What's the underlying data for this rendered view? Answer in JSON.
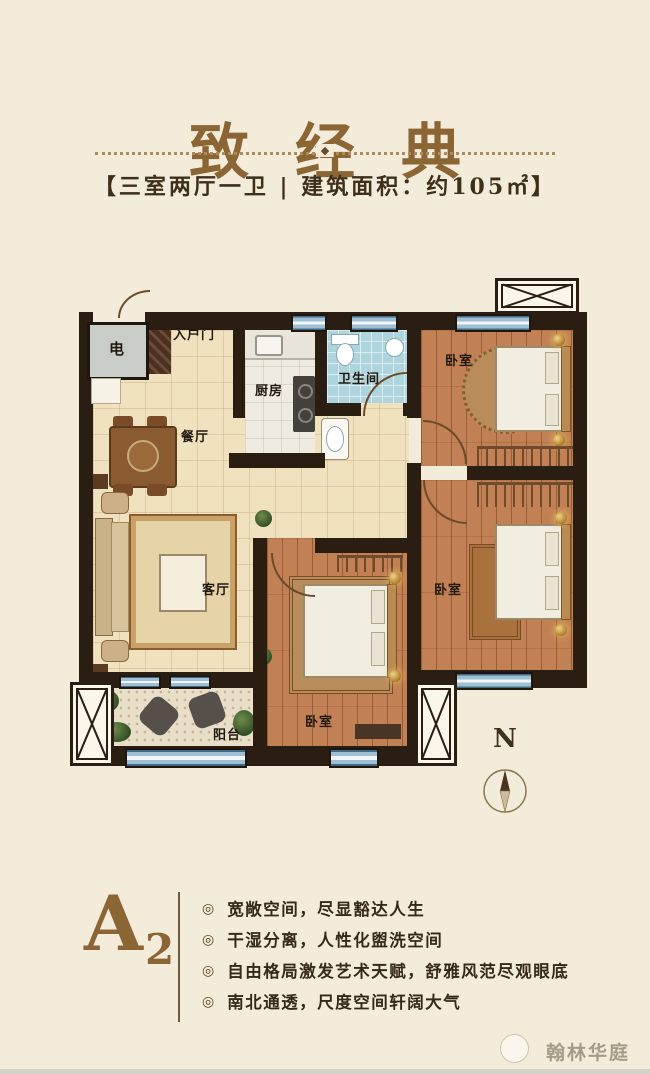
{
  "header": {
    "title": "致经典",
    "ornament": "◆",
    "subtitle": "【三室两厅一卫 | 建筑面积：约105㎡】"
  },
  "plan": {
    "rooms": {
      "electric": "电",
      "entry_door": "入户门",
      "kitchen": "厨房",
      "bathroom": "卫生间",
      "bedroom": "卧室",
      "dining": "餐厅",
      "living": "客厅",
      "balcony": "阳台"
    },
    "compass": "N"
  },
  "unit": {
    "letter": "A",
    "number": "2"
  },
  "bullets": {
    "glyph": "◎"
  },
  "features": [
    "宽敞空间，尽显豁达人生",
    "干湿分离，人性化盥洗空间",
    "自由格局激发艺术天赋，舒雅风范尽观眼底",
    "南北通透，尺度空间轩阔大气"
  ],
  "watermark": "翰林华庭",
  "colors": {
    "background": "#f4ecda",
    "accent_brown": "#8c6535",
    "text_dark": "#352a1a",
    "wall": "#2a1e12",
    "window_blue": "#9fc0d2",
    "bath_blue": "#aed4de",
    "wood_floor": "#c28155",
    "tile_floor": "#f0e2bf"
  }
}
